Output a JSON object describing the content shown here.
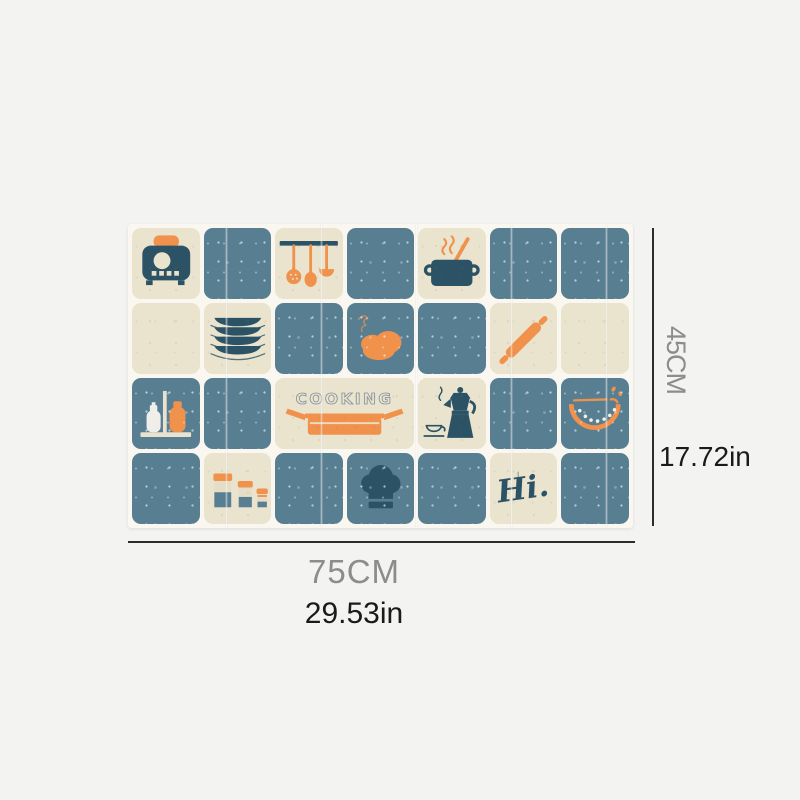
{
  "dimensions": {
    "height_cm": "45CM",
    "height_in": "17.72in",
    "width_cm": "75CM",
    "width_in": "29.53in"
  },
  "mat": {
    "cooking_label": "COOKING",
    "script_label": "Hi.",
    "grid": {
      "columns": 7,
      "rows": 4
    },
    "tiles": [
      {
        "row": 1,
        "col": 1,
        "bg": "cream",
        "icon": "toaster"
      },
      {
        "row": 1,
        "col": 2,
        "bg": "blue",
        "icon": "none"
      },
      {
        "row": 1,
        "col": 3,
        "bg": "cream",
        "icon": "utensil-rack"
      },
      {
        "row": 1,
        "col": 4,
        "bg": "blue",
        "icon": "none"
      },
      {
        "row": 1,
        "col": 5,
        "bg": "cream",
        "icon": "cooking-pot"
      },
      {
        "row": 1,
        "col": 6,
        "bg": "blue",
        "icon": "none"
      },
      {
        "row": 1,
        "col": 7,
        "bg": "blue",
        "icon": "none"
      },
      {
        "row": 2,
        "col": 1,
        "bg": "cream",
        "icon": "none"
      },
      {
        "row": 2,
        "col": 2,
        "bg": "cream",
        "icon": "plate-stack"
      },
      {
        "row": 2,
        "col": 3,
        "bg": "blue",
        "icon": "none"
      },
      {
        "row": 2,
        "col": 4,
        "bg": "blue",
        "icon": "bread"
      },
      {
        "row": 2,
        "col": 5,
        "bg": "blue",
        "icon": "none"
      },
      {
        "row": 2,
        "col": 6,
        "bg": "cream",
        "icon": "rolling-pin"
      },
      {
        "row": 2,
        "col": 7,
        "bg": "cream",
        "icon": "none"
      },
      {
        "row": 3,
        "col": 1,
        "bg": "blue",
        "icon": "salt-pepper-shakers"
      },
      {
        "row": 3,
        "col": 2,
        "bg": "blue",
        "icon": "none"
      },
      {
        "row": 3,
        "col": 3,
        "bg": "cream",
        "icon": "cooking-text-pan",
        "span": 2
      },
      {
        "row": 3,
        "col": 5,
        "bg": "cream",
        "icon": "moka-pot-cup"
      },
      {
        "row": 3,
        "col": 6,
        "bg": "blue",
        "icon": "none"
      },
      {
        "row": 3,
        "col": 7,
        "bg": "blue",
        "icon": "watermelon"
      },
      {
        "row": 4,
        "col": 1,
        "bg": "blue",
        "icon": "none"
      },
      {
        "row": 4,
        "col": 2,
        "bg": "cream",
        "icon": "spice-jars"
      },
      {
        "row": 4,
        "col": 3,
        "bg": "blue",
        "icon": "none"
      },
      {
        "row": 4,
        "col": 4,
        "bg": "blue",
        "icon": "chef-hat"
      },
      {
        "row": 4,
        "col": 5,
        "bg": "blue",
        "icon": "none"
      },
      {
        "row": 4,
        "col": 6,
        "bg": "cream",
        "icon": "hi-script"
      },
      {
        "row": 4,
        "col": 7,
        "bg": "blue",
        "icon": "none"
      }
    ]
  },
  "colors": {
    "page_background": "#f3f3f2",
    "mat_base": "#f9f7f0",
    "cream_tile": "#eae3cd",
    "blue_tile": "#587e92",
    "navy_ink": "#2c5365",
    "orange_ink": "#f0914c",
    "dimension_gray": "#8c8c8c",
    "dimension_black": "#1a1a1a"
  }
}
